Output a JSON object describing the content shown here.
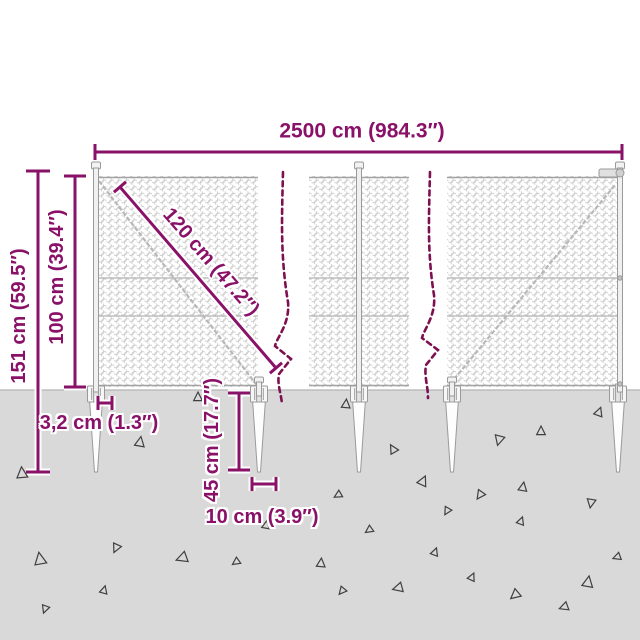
{
  "colors": {
    "dimension": "#8a1168",
    "break_line": "#7d1150",
    "ground": "#d9d9d9",
    "mesh_wire": "#c9c9c9",
    "structure": "#9a9a9a",
    "triangle": "#3f3f3f"
  },
  "dimensions": {
    "total_width": "2500 cm (984.3″)",
    "total_height": "151 cm (59.5″)",
    "fence_height": "100 cm (39.4″)",
    "mesh_diagonal": "120 cm (47.2″)",
    "post_width": "3,2 cm (1.3″)",
    "spike_length": "45 cm (17.7″)",
    "spike_width": "10 cm (3.9″)"
  },
  "ground": {
    "triangles": [
      {
        "x": 22,
        "y": 473,
        "s": 10,
        "r": 355
      },
      {
        "x": 140,
        "y": 442,
        "s": 9,
        "r": 10
      },
      {
        "x": 198,
        "y": 397,
        "s": 8,
        "r": 0
      },
      {
        "x": 346,
        "y": 404,
        "s": 8,
        "r": 5
      },
      {
        "x": 393,
        "y": 449,
        "s": 8,
        "r": 330
      },
      {
        "x": 423,
        "y": 481,
        "s": 9,
        "r": 25
      },
      {
        "x": 499,
        "y": 440,
        "s": 9,
        "r": 195
      },
      {
        "x": 541,
        "y": 431,
        "s": 8,
        "r": 0
      },
      {
        "x": 523,
        "y": 487,
        "s": 8,
        "r": 10
      },
      {
        "x": 480,
        "y": 495,
        "s": 8,
        "r": 215
      },
      {
        "x": 338,
        "y": 495,
        "s": 7,
        "r": 240
      },
      {
        "x": 599,
        "y": 412,
        "s": 8,
        "r": 20
      },
      {
        "x": 40,
        "y": 559,
        "s": 11,
        "r": 350
      },
      {
        "x": 45,
        "y": 609,
        "s": 7,
        "r": 200
      },
      {
        "x": 104,
        "y": 590,
        "s": 7,
        "r": 15
      },
      {
        "x": 116,
        "y": 548,
        "s": 8,
        "r": 205
      },
      {
        "x": 182,
        "y": 558,
        "s": 10,
        "r": 250
      },
      {
        "x": 236,
        "y": 562,
        "s": 7,
        "r": 235
      },
      {
        "x": 266,
        "y": 525,
        "s": 7,
        "r": 10
      },
      {
        "x": 321,
        "y": 563,
        "s": 8,
        "r": 5
      },
      {
        "x": 342,
        "y": 591,
        "s": 7,
        "r": 220
      },
      {
        "x": 369,
        "y": 530,
        "s": 7,
        "r": 235
      },
      {
        "x": 398,
        "y": 588,
        "s": 9,
        "r": 255
      },
      {
        "x": 435,
        "y": 552,
        "s": 7,
        "r": 20
      },
      {
        "x": 447,
        "y": 511,
        "s": 7,
        "r": 210
      },
      {
        "x": 472,
        "y": 577,
        "s": 7,
        "r": 25
      },
      {
        "x": 515,
        "y": 595,
        "s": 9,
        "r": 230
      },
      {
        "x": 521,
        "y": 521,
        "s": 7,
        "r": 20
      },
      {
        "x": 564,
        "y": 607,
        "s": 8,
        "r": 250
      },
      {
        "x": 588,
        "y": 582,
        "s": 10,
        "r": 10
      },
      {
        "x": 591,
        "y": 503,
        "s": 8,
        "r": 190
      },
      {
        "x": 617,
        "y": 557,
        "s": 7,
        "r": 250
      }
    ]
  }
}
